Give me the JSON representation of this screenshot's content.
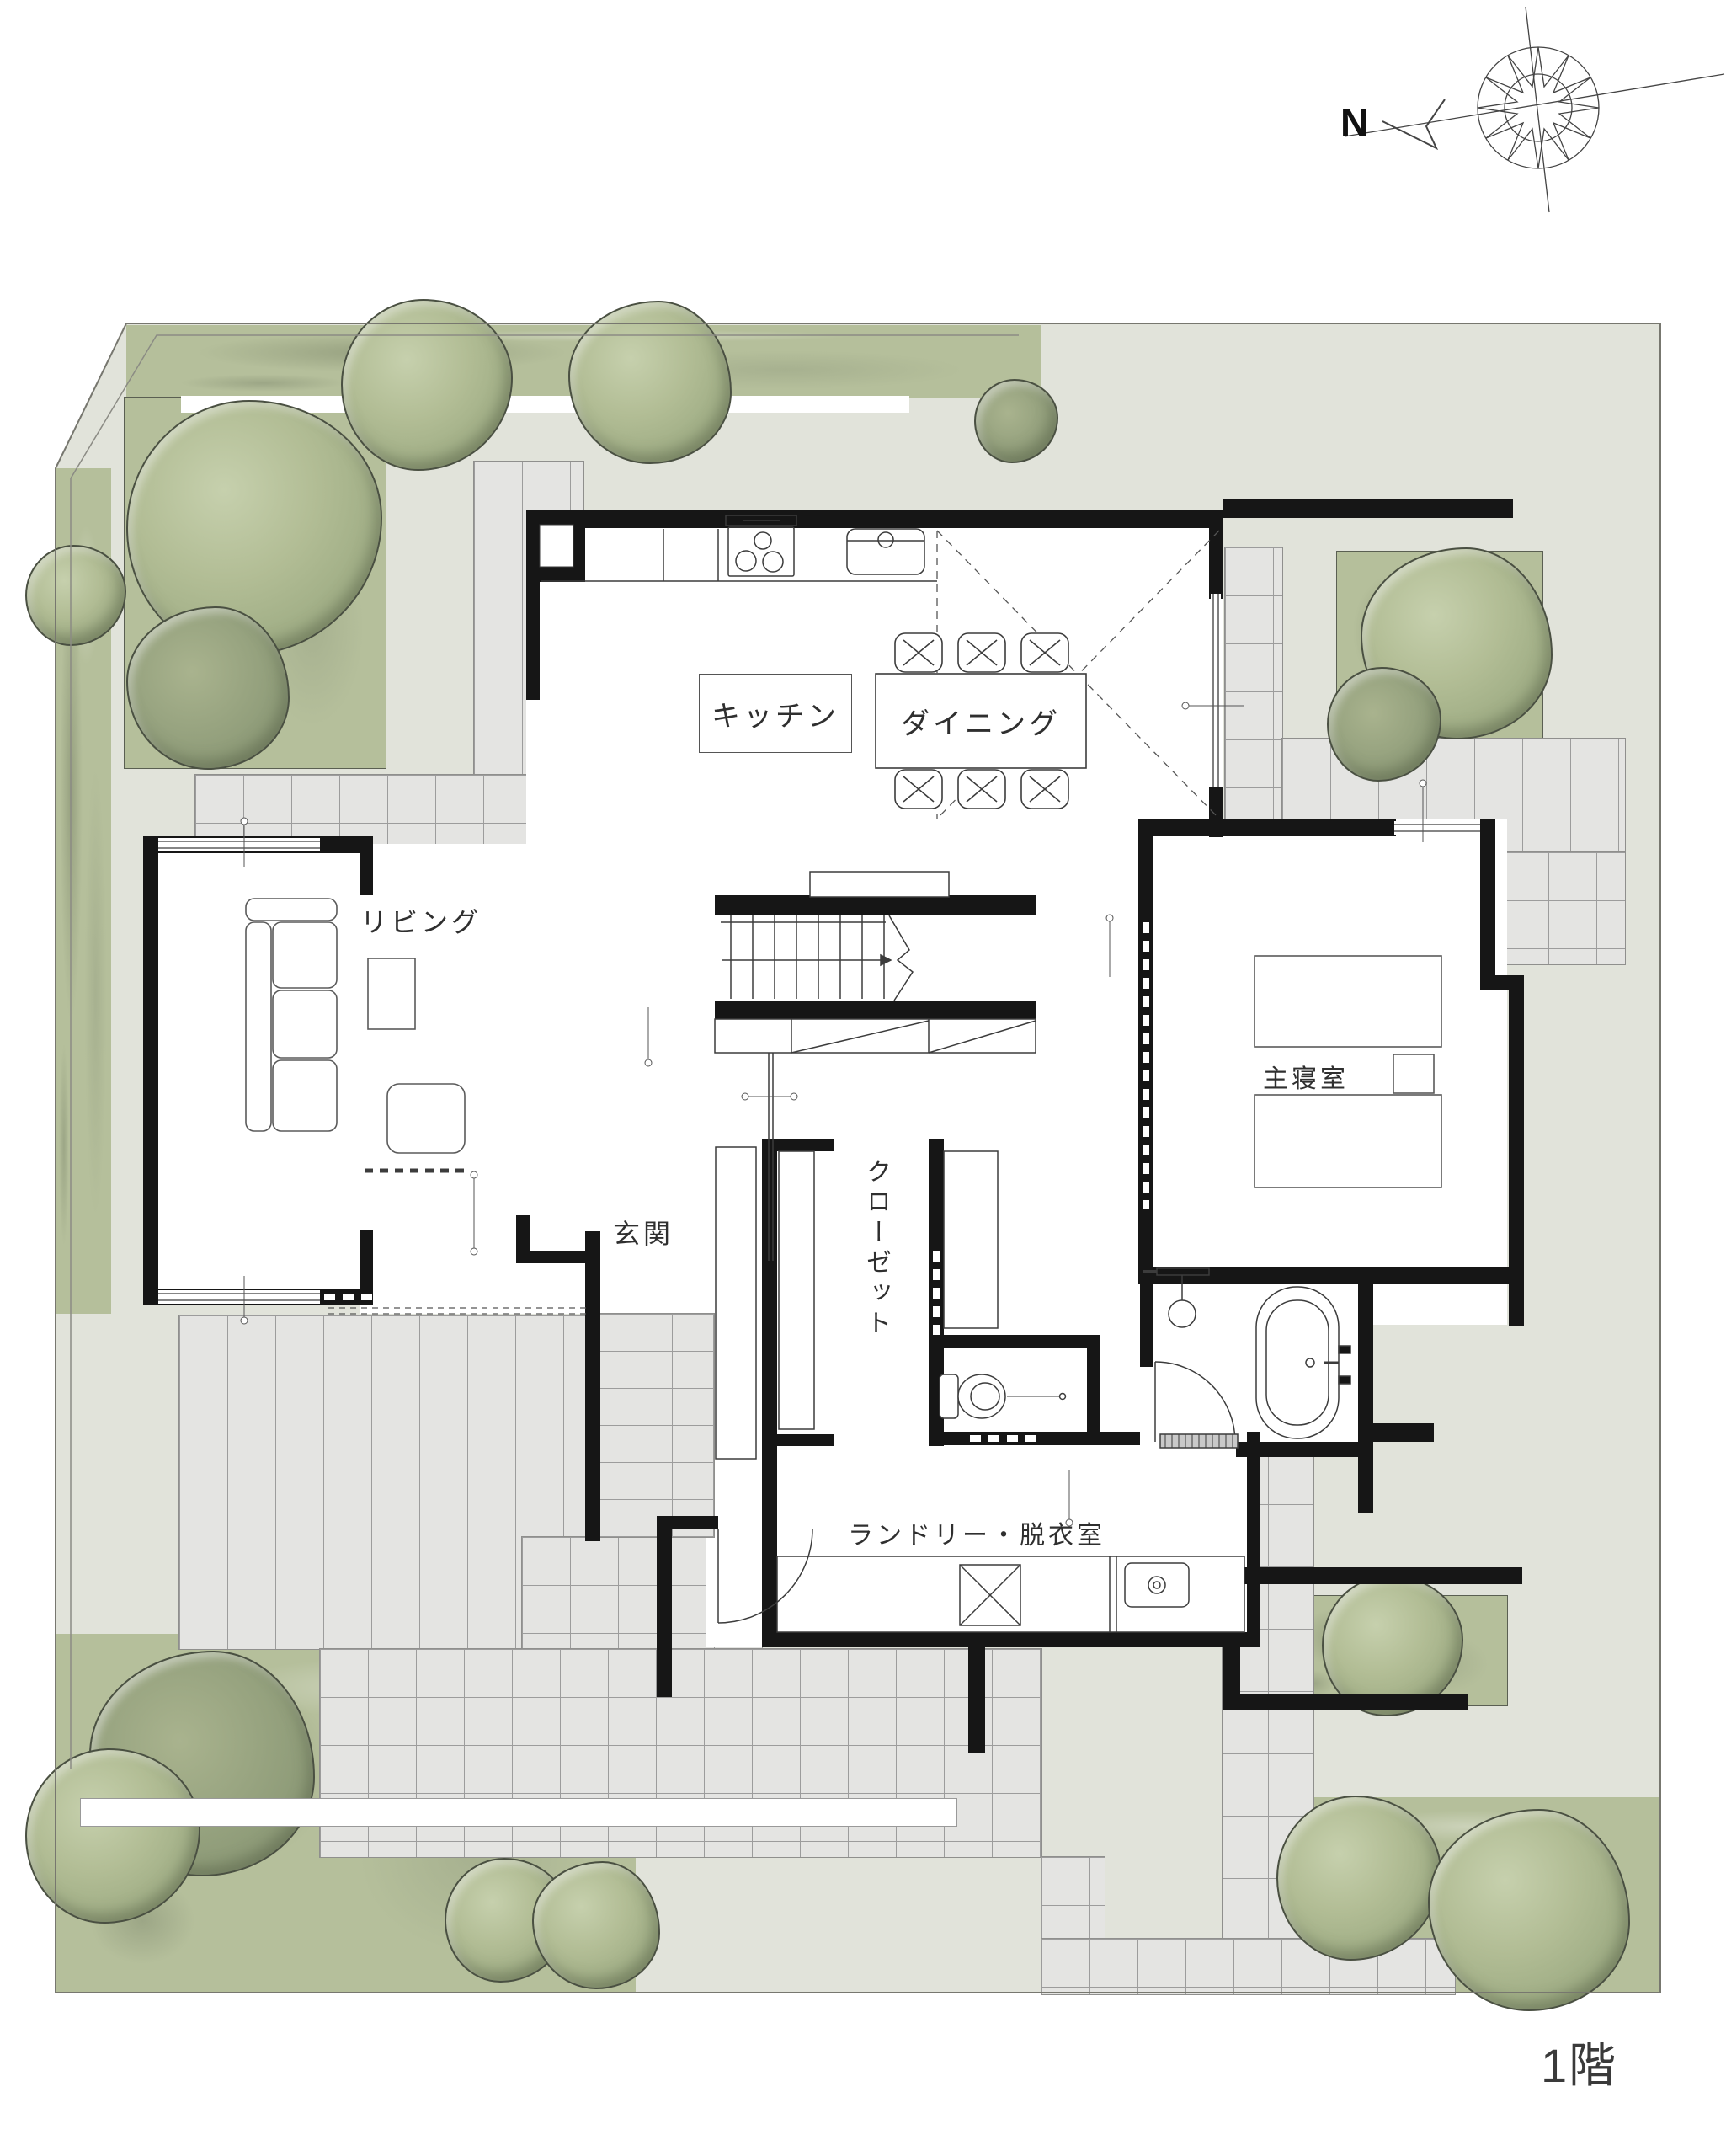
{
  "title": "1F floor plan with site landscaping",
  "floor": {
    "label": "1階"
  },
  "compass": {
    "label": "N"
  },
  "rooms": {
    "kitchen": {
      "label": "キッチン"
    },
    "dining": {
      "label": "ダイニング"
    },
    "living": {
      "label": "リビング"
    },
    "entrance": {
      "label": "玄関"
    },
    "closet": {
      "label": "クローゼット"
    },
    "master_bedroom": {
      "label": "主寝室"
    },
    "laundry": {
      "label": "ランドリー・脱衣室"
    }
  },
  "colors": {
    "site_background": "#e1e3da",
    "garden_green": "#b5bf9b",
    "tile_gray": "#e4e4e2",
    "wall_black": "#161616",
    "tree_outline": "#4a5042",
    "line_gray": "#3c3c3c"
  }
}
